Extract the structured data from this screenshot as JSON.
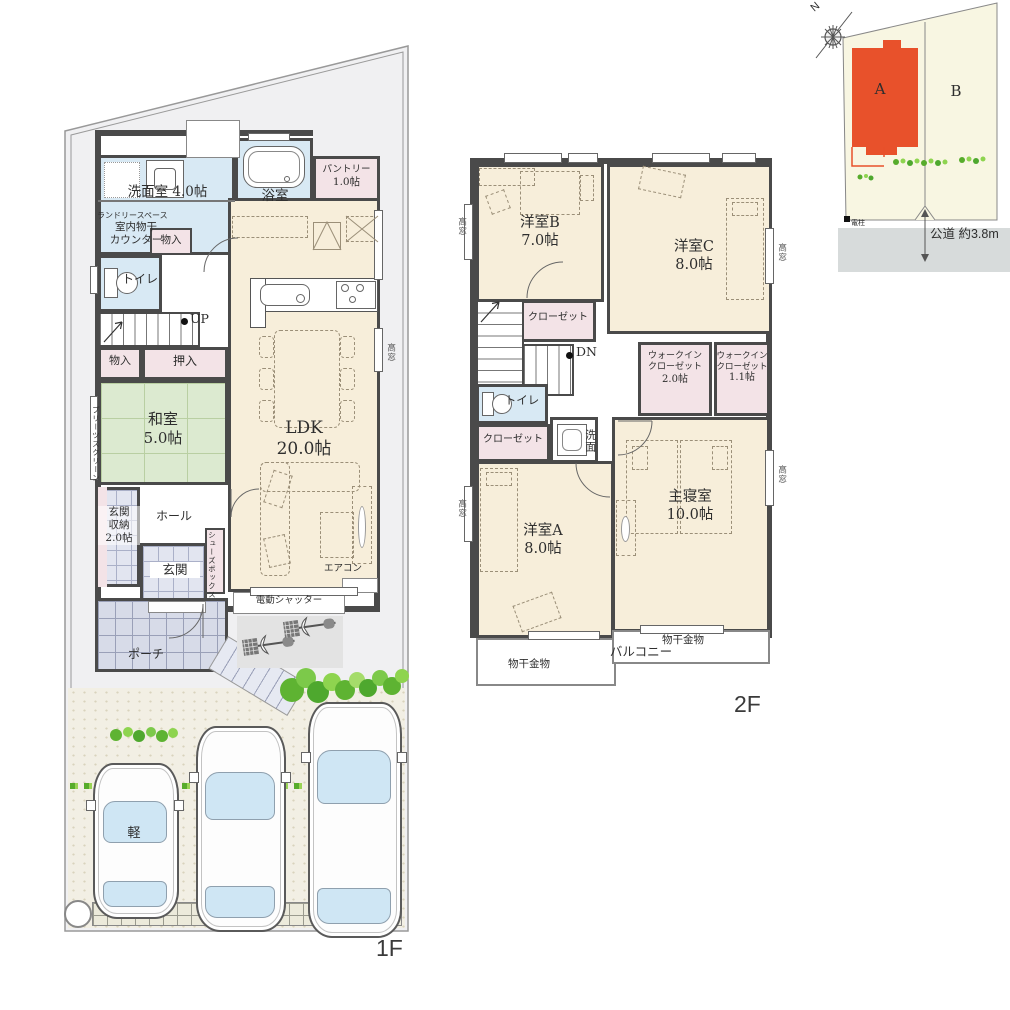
{
  "f1": {
    "label": "1F",
    "senmenshitsu": "洗面室 4.0帖",
    "laundry_space": "ランドリースペース",
    "indoor_dry_1": "室内物干",
    "indoor_dry_2": "カウンター",
    "monoire_a": "物入",
    "yokushitsu": "浴室",
    "pantry_1": "パントリー",
    "pantry_2": "1.0帖",
    "toilet": "トイレ",
    "up": "UP",
    "monoire_b": "物入",
    "oshiire": "押入",
    "washitsu_1": "和室",
    "washitsu_2": "5.0帖",
    "pleats_screen": "プリーツスクリーン",
    "ldk_1": "LDK",
    "ldk_2": "20.0帖",
    "takamado": "高窓",
    "genkan_shunou_1": "玄関",
    "genkan_shunou_2": "収納",
    "genkan_shunou_3": "2.0帖",
    "hall": "ホール",
    "shoes_box": "シューズボックス",
    "genkan": "玄関",
    "aircon": "エアコン",
    "shutter": "電動シャッター",
    "porch": "ポーチ",
    "kei_car": "軽"
  },
  "f2": {
    "label": "2F",
    "room_b_1": "洋室B",
    "room_b_2": "7.0帖",
    "room_c_1": "洋室C",
    "room_c_2": "8.0帖",
    "closet_top": "クローゼット",
    "closet_mid": "クローゼット",
    "dn": "DN",
    "toilet": "トイレ",
    "wic_line1": "ウォークイン",
    "wic_line2": "クローゼット",
    "wic2_size": "2.0帖",
    "wic11_size": "1.1帖",
    "senmen": "洗面",
    "room_a_1": "洋室A",
    "room_a_2": "8.0帖",
    "master_1": "主寝室",
    "master_2": "10.0帖",
    "monohoshi_left": "物干金物",
    "monohoshi_right": "物干金物",
    "balcony": "バルコニー",
    "takamado": "高窓"
  },
  "site": {
    "lot_a": "A",
    "lot_b": "B",
    "pole": "電柱",
    "road": "公道 約3.8m",
    "north": "N"
  },
  "colors": {
    "wall": "#4a4a4a",
    "water_blue": "#d8e9f4",
    "closet_pink": "#f3e3e7",
    "tatami_green": "#dcead0",
    "ldk_cream": "#f7eeda",
    "tile_blue": "#e2e5f0",
    "site_grey": "#f0f0f2",
    "drive_cream": "#f2efe4",
    "lot_cream": "#f8f6e2",
    "road_grey": "#d7dbdb",
    "building_a_orange": "#e8512b",
    "tree_green": "#5eb332"
  }
}
